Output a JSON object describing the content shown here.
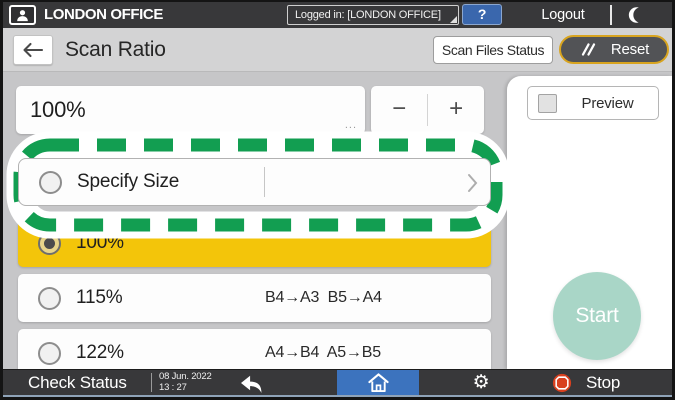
{
  "top_bar": {
    "account_name": "LONDON OFFICE",
    "logged_in_status": "Logged in: [LONDON OFFICE]",
    "help_label": "?",
    "logout_label": "Logout"
  },
  "header": {
    "title": "Scan Ratio",
    "scan_files_status_label": "Scan Files Status",
    "reset_label": "Reset"
  },
  "ratio_editor": {
    "value": "100%",
    "ellipsis": "...",
    "minus_label": "−",
    "plus_label": "+"
  },
  "specify_size": {
    "label": "Specify Size"
  },
  "ratio_options": [
    {
      "label": "100%",
      "conversion": "",
      "selected": true
    },
    {
      "label": "115%",
      "conversion": "B4→A3  B5→A4",
      "selected": false
    },
    {
      "label": "122%",
      "conversion": "A4→B4  A5→B5",
      "selected": false
    }
  ],
  "right_panel": {
    "preview_label": "Preview",
    "start_label": "Start"
  },
  "bottom_bar": {
    "check_status_label": "Check Status",
    "date": "08 Jun. 2022",
    "time": "13 : 27",
    "stop_label": "Stop"
  },
  "annotation": {
    "type": "dashed-highlight",
    "target": "Specify Size row",
    "color": "#129e51"
  },
  "colors": {
    "bar_background": "#38383a",
    "header_background": "#d3d3d4",
    "content_background": "#c6c6c8",
    "selected_row_yellow": "#f3c50a",
    "reset_border_gold": "#d8a41f",
    "home_active_blue": "#3c73be",
    "help_blue": "#3a67ad",
    "start_mint": "#a9d6c7",
    "stop_red": "#d8401f",
    "annotation_green": "#129e51"
  }
}
